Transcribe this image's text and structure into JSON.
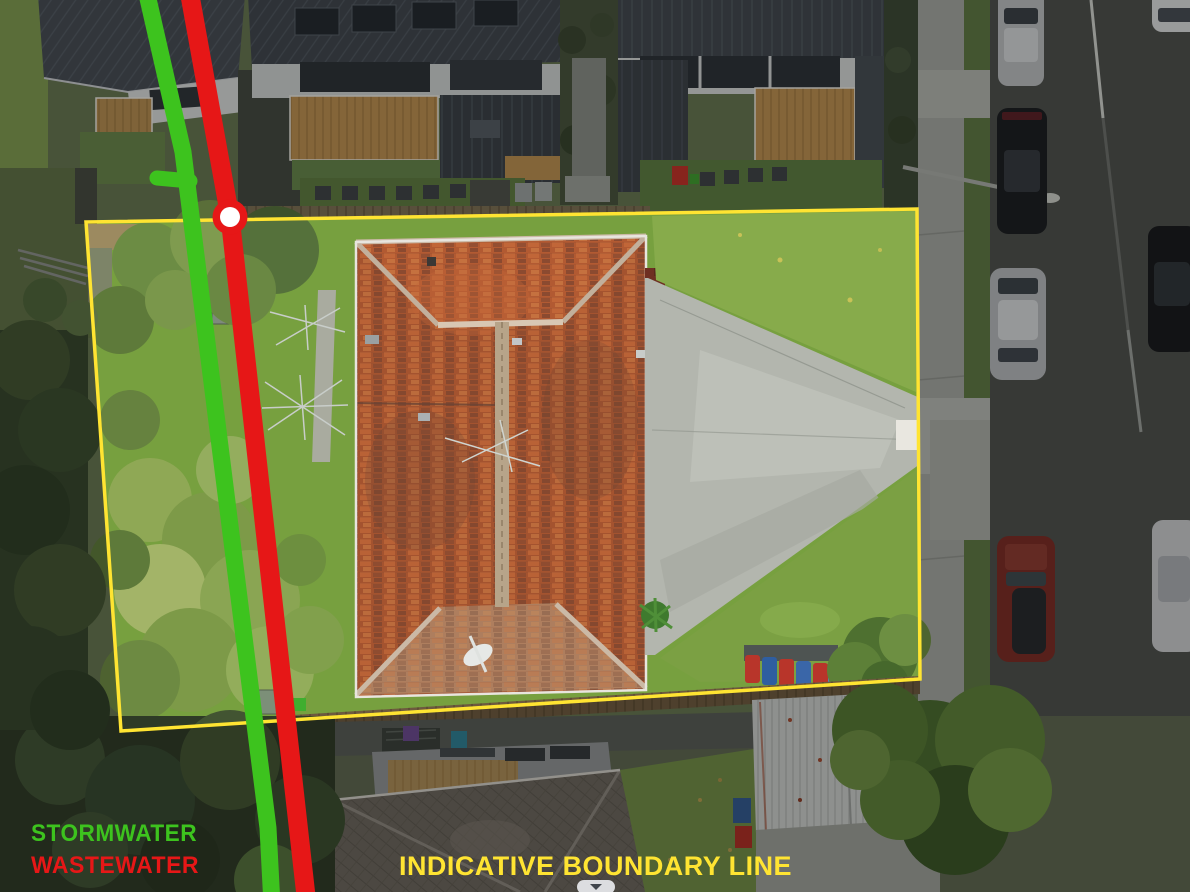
{
  "annotations": {
    "stormwater": {
      "label": "STORMWATER",
      "color": "#3DC31E"
    },
    "wastewater": {
      "label": "WASTEWATER",
      "color": "#E61717"
    },
    "boundary": {
      "label": "INDICATIVE BOUNDARY LINE",
      "color": "#FFE432"
    }
  },
  "markers": {
    "junction": {
      "ring_color": "#E61717",
      "center_color": "#FFFFFF"
    }
  },
  "viewer": {
    "collapse_button_icon": "chevron-down"
  }
}
